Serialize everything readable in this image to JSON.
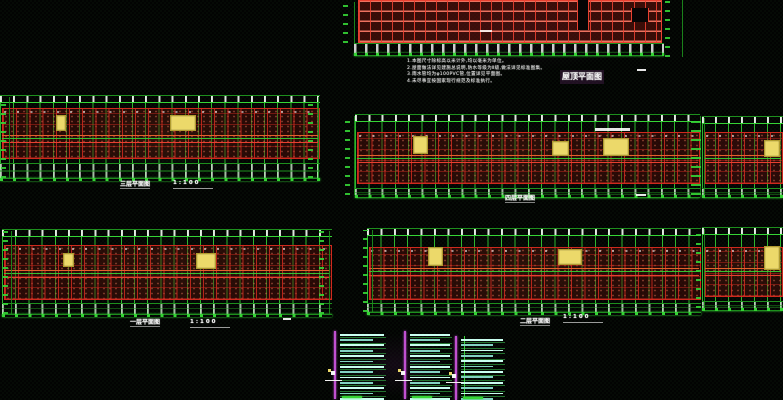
{
  "app": {
    "name": "cad-drawing-viewer",
    "background": "#020302"
  },
  "colors": {
    "grid_green": "#35d435",
    "grid_green_dim": "#1d8f1d",
    "wall_red": "#cf2a1e",
    "wall_red_bright": "#e84030",
    "wall_fill_dark": "#5a100a",
    "corridor_orange": "#e2622c",
    "highlight_yellow": "#ecd96a",
    "detail_cyan": "#c9fff0",
    "detail_cyan_dim": "#82d2c2",
    "axis_magenta": "#c050d0",
    "text_white": "#f2f2f2"
  },
  "canvas": {
    "notes": {
      "x": 407,
      "y": 59,
      "lines": [
        "1.本图尺寸除标高以米计外,均以毫米为单位。",
        "2.屋面做法详见建施总说明,防水等级为Ⅱ级,做法详见标准图集。",
        "3.雨水管均为φ100PVC管,位置详见平面图。",
        "4.未尽事宜按国家现行规范及标准执行。"
      ]
    },
    "roof_title": {
      "x": 560,
      "y": 70,
      "text": "屋顶平面图"
    },
    "misc_dashes": [
      {
        "x": 637,
        "y": 69,
        "w": 9,
        "h": 2
      },
      {
        "x": 636,
        "y": 194,
        "w": 10,
        "h": 2
      },
      {
        "x": 283,
        "y": 318,
        "w": 8,
        "h": 2
      }
    ],
    "plans": [
      {
        "id": "roof-plan",
        "type": "roof",
        "x": 342,
        "y": 0,
        "w": 346,
        "h": 58,
        "grid": {
          "x0": 16,
          "x1": 318,
          "y0": 0,
          "y1": 41
        },
        "vstep": 11,
        "hstep": 10,
        "joints": [
          {
            "x": 219,
            "y": 0,
            "w": 10,
            "h": 30
          },
          {
            "x": 273,
            "y": 8,
            "w": 16,
            "h": 14
          }
        ],
        "lmark": {
          "x": 0,
          "w": 12
        },
        "rmark": {
          "x": 322,
          "w": 18
        },
        "dims": {
          "y": 43,
          "h": 11
        },
        "dots_y": 53
      },
      {
        "id": "plan-3f",
        "type": "floor",
        "title": "三层平面图",
        "title_x": 120,
        "title_y": 179,
        "title2": "1:100",
        "title2_x": 173,
        "title2_y": 180,
        "x": 0,
        "y": 93,
        "w": 320,
        "h": 96,
        "step": 13.2,
        "gy0": 4,
        "wy0": 15,
        "wy1": 64,
        "cy": 42,
        "btm": {
          "y": 70,
          "h": 14
        },
        "dots_y": 85,
        "yellows": [
          {
            "x": 56,
            "y": 22,
            "w": 8,
            "h": 14
          },
          {
            "x": 170,
            "y": 22,
            "w": 24,
            "h": 14
          }
        ],
        "lmark": {
          "x": 0,
          "w": 9
        },
        "rmark": {
          "x": 307,
          "w": 11
        }
      },
      {
        "id": "plan-4f",
        "type": "floor",
        "title": "四层平面图",
        "title_x": 505,
        "title_y": 193,
        "x": 355,
        "y": 111,
        "w": 345,
        "h": 92,
        "step": 13.3,
        "gy0": 5,
        "wy0": 21,
        "wy1": 71,
        "cy": 44,
        "btm": {
          "y": 77,
          "h": 8
        },
        "dots_y": 84,
        "yellows": [
          {
            "x": 58,
            "y": 25,
            "w": 13,
            "h": 16
          },
          {
            "x": 197,
            "y": 30,
            "w": 15,
            "h": 13
          },
          {
            "x": 248,
            "y": 27,
            "w": 24,
            "h": 16
          }
        ],
        "lmark": {
          "x": -11,
          "w": 10
        },
        "rmark": {
          "x": 335,
          "w": 10
        },
        "wdash": {
          "x": 240,
          "y": 17,
          "w": 35,
          "h": 3
        }
      },
      {
        "id": "plan-right-upper",
        "type": "floor",
        "x": 702,
        "y": 111,
        "w": 81,
        "h": 92,
        "step": 13,
        "gy0": 7,
        "wy0": 21,
        "wy1": 71,
        "cy": 44,
        "btm": {
          "y": 77,
          "h": 8
        },
        "dots_y": 84,
        "yellows": [
          {
            "x": 62,
            "y": 29,
            "w": 14,
            "h": 15
          }
        ],
        "lmark": {
          "x": -7,
          "w": 9
        }
      },
      {
        "id": "plan-1f",
        "type": "floor",
        "title": "一层平面图",
        "title_x": 130,
        "title_y": 317,
        "title2": "1:100",
        "title2_x": 190,
        "title2_y": 319,
        "x": 2,
        "y": 226,
        "w": 330,
        "h": 96,
        "step": 13.2,
        "gy0": 5,
        "wy0": 19,
        "wy1": 72,
        "cy": 44,
        "btm": {
          "y": 77,
          "h": 10
        },
        "dots_y": 88,
        "yellows": [
          {
            "x": 61,
            "y": 27,
            "w": 9,
            "h": 12
          },
          {
            "x": 194,
            "y": 27,
            "w": 18,
            "h": 14
          }
        ],
        "lmark": {
          "x": 0,
          "w": 9
        },
        "rmark": {
          "x": 316,
          "w": 11
        }
      },
      {
        "id": "plan-2f",
        "type": "floor",
        "title": "二层平面图",
        "title_x": 520,
        "title_y": 316,
        "title2": "1:100",
        "title2_x": 563,
        "title2_y": 314,
        "x": 367,
        "y": 226,
        "w": 334,
        "h": 92,
        "step": 13.4,
        "gy0": 4,
        "wy0": 21,
        "wy1": 72,
        "cy": 42,
        "btm": {
          "y": 77,
          "h": 8
        },
        "dots_y": 86,
        "yellows": [
          {
            "x": 61,
            "y": 21,
            "w": 13,
            "h": 17
          },
          {
            "x": 191,
            "y": 23,
            "w": 22,
            "h": 14
          }
        ],
        "lmark": {
          "x": -5,
          "w": 10
        }
      },
      {
        "id": "plan-right-lower",
        "type": "floor",
        "x": 702,
        "y": 224,
        "w": 81,
        "h": 92,
        "step": 13,
        "gy0": 5,
        "wy0": 23,
        "wy1": 71,
        "cy": 44,
        "btm": {
          "y": 77,
          "h": 8
        },
        "dots_y": 84,
        "yellows": [
          {
            "x": 62,
            "y": 22,
            "w": 14,
            "h": 22
          }
        ],
        "lmark": {
          "x": -7,
          "w": 9
        }
      }
    ],
    "details": [
      {
        "id": "stair-detail-1",
        "x": 334,
        "y": 333,
        "w": 54,
        "h": 64,
        "rows": 14,
        "magenta": true,
        "green_axis": false
      },
      {
        "id": "stair-detail-2",
        "x": 404,
        "y": 333,
        "w": 50,
        "h": 64,
        "rows": 14,
        "magenta": true,
        "green_axis": false
      },
      {
        "id": "stair-detail-3",
        "x": 455,
        "y": 338,
        "w": 52,
        "h": 60,
        "rows": 13,
        "magenta": true,
        "green_axis": true
      }
    ]
  }
}
